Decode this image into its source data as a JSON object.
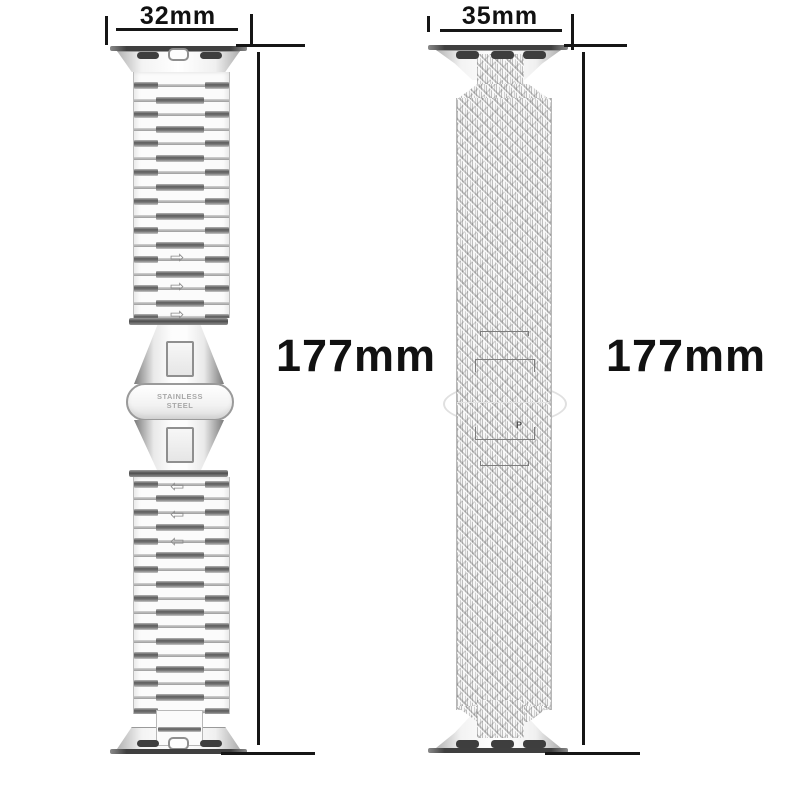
{
  "diagram": {
    "background_color": "#ffffff",
    "dimension_line_color": "#161616",
    "left_band": {
      "kind": "stainless-steel-link-band",
      "width_label": "32mm",
      "length_label": "177mm",
      "clasp_text_line1": "STAINLESS",
      "clasp_text_line2": "STEEL",
      "adjust_arrow_up": "⇨",
      "adjust_arrow_down": "⇦"
    },
    "right_band": {
      "kind": "milanese-mesh-band",
      "width_label": "35mm",
      "length_label": "177mm",
      "clasp_mark": "P"
    }
  }
}
